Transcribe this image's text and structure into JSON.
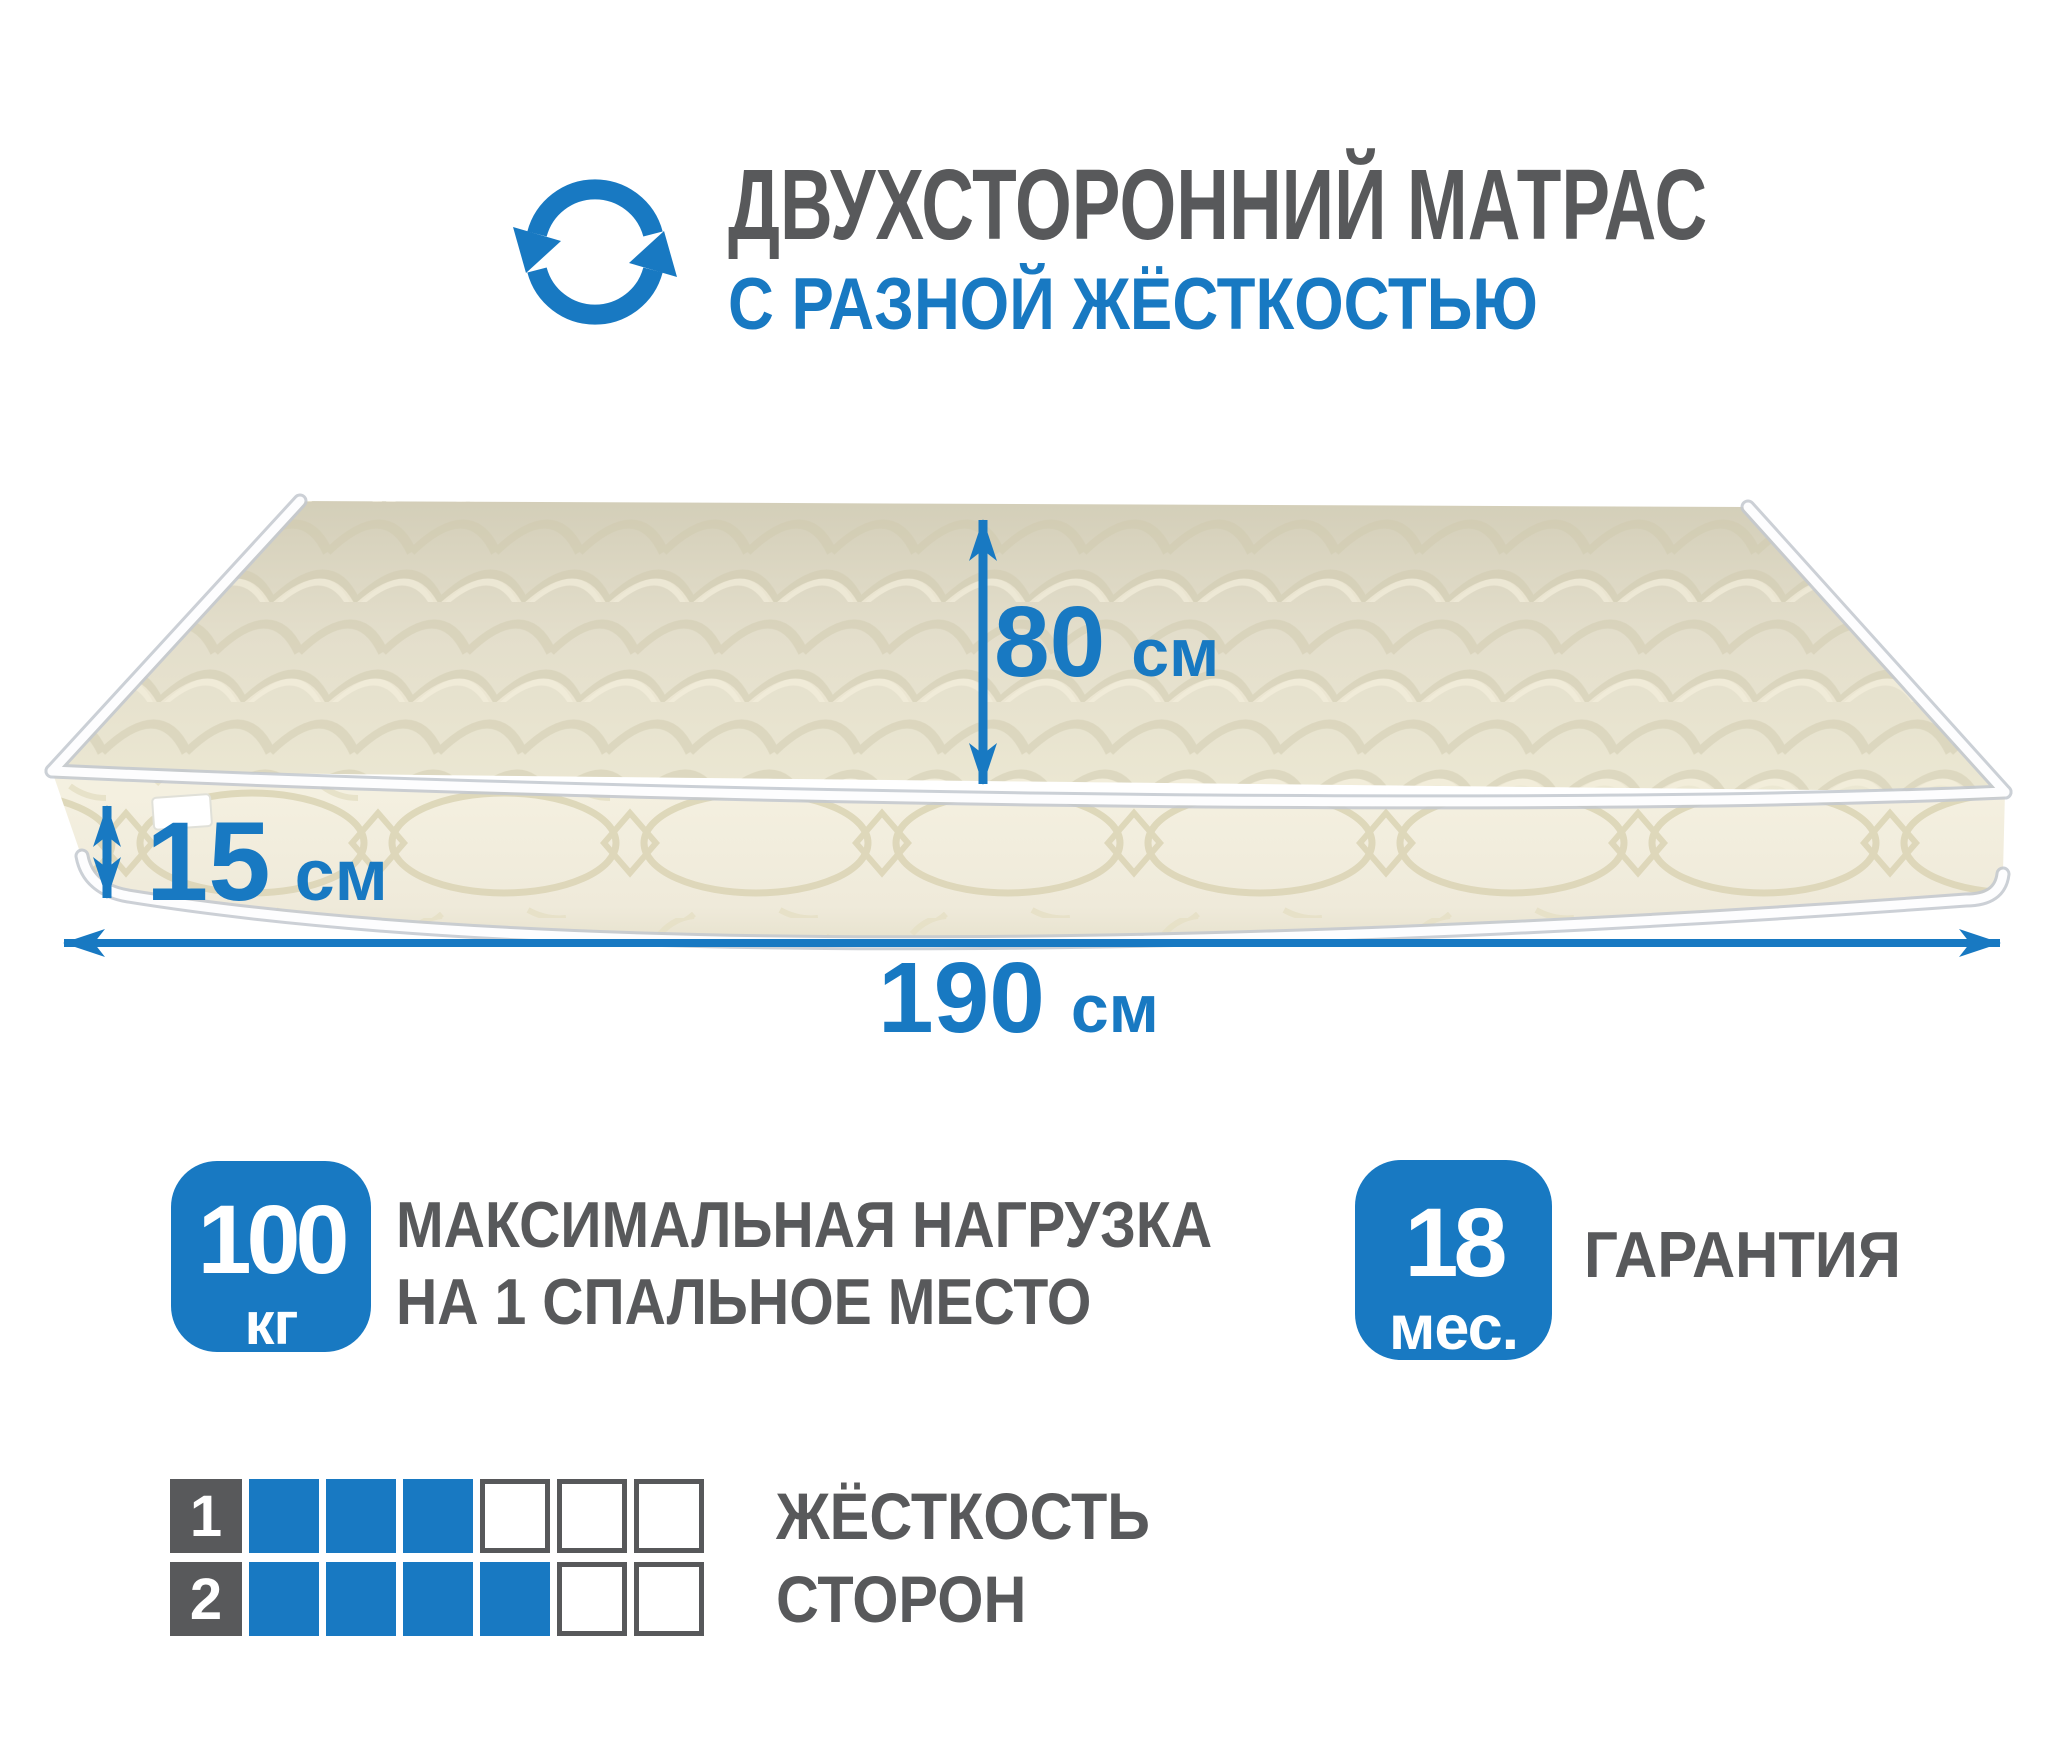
{
  "page": {
    "background": "#ffffff",
    "width": 2048,
    "height": 1757
  },
  "colors": {
    "accent": "#1879c2",
    "text_gray": "#58595b",
    "mattress_top": "#e7e2cc",
    "mattress_side": "#f2eedc",
    "piping": "#ffffff"
  },
  "header": {
    "icon": "rotate-arrows-icon",
    "title_line1": "ДВУХСТОРОННИЙ МАТРАС",
    "title_line2": "С РАЗНОЙ ЖЁСТКОСТЬЮ"
  },
  "dimensions": {
    "width": {
      "value": "80",
      "unit": "см"
    },
    "thickness": {
      "value": "15",
      "unit": "см"
    },
    "length": {
      "value": "190",
      "unit": "см"
    }
  },
  "specs": {
    "max_load": {
      "badge_value": "100",
      "badge_unit": "кг",
      "label_line1": "МАКСИМАЛЬНАЯ НАГРУЗКА",
      "label_line2": "НА 1 СПАЛЬНОЕ МЕСТО"
    },
    "warranty": {
      "badge_value": "18",
      "badge_unit": "мес.",
      "label": "ГАРАНТИЯ"
    }
  },
  "firmness": {
    "side_label_line1": "ЖЁСТКОСТЬ",
    "side_label_line2": "СТОРОН",
    "rows": [
      {
        "label": "1",
        "filled": 3,
        "total": 6
      },
      {
        "label": "2",
        "filled": 4,
        "total": 6
      }
    ]
  }
}
